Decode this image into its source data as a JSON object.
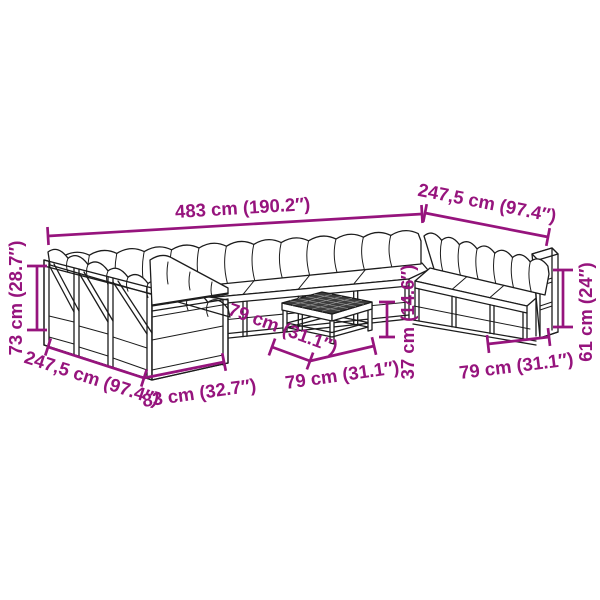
{
  "diagram": {
    "background_color": "#FFFFFF",
    "accent_color": "#96147D",
    "line_color": "#1C1C1C",
    "table_top_color": "#3D3D3D",
    "illustration": "u-shaped-garden-pallet-sofa-set-with-coffee-table",
    "dimensions": {
      "back_total_width": "483 cm (190.2″)",
      "right_section_depth": "247,5 cm (97.4″)",
      "left_section_depth": "247,5 cm (97.4″)",
      "backrest_height": "73 cm (28.7″)",
      "left_module_width": "83 cm (32.7″)",
      "table_depth": "79 cm (31.1″)",
      "table_width": "79 cm (31.1″)",
      "table_height": "37 cm (14.6″)",
      "right_module_width": "79 cm (31.1″)",
      "armrest_height": "61 cm (24″)"
    }
  }
}
